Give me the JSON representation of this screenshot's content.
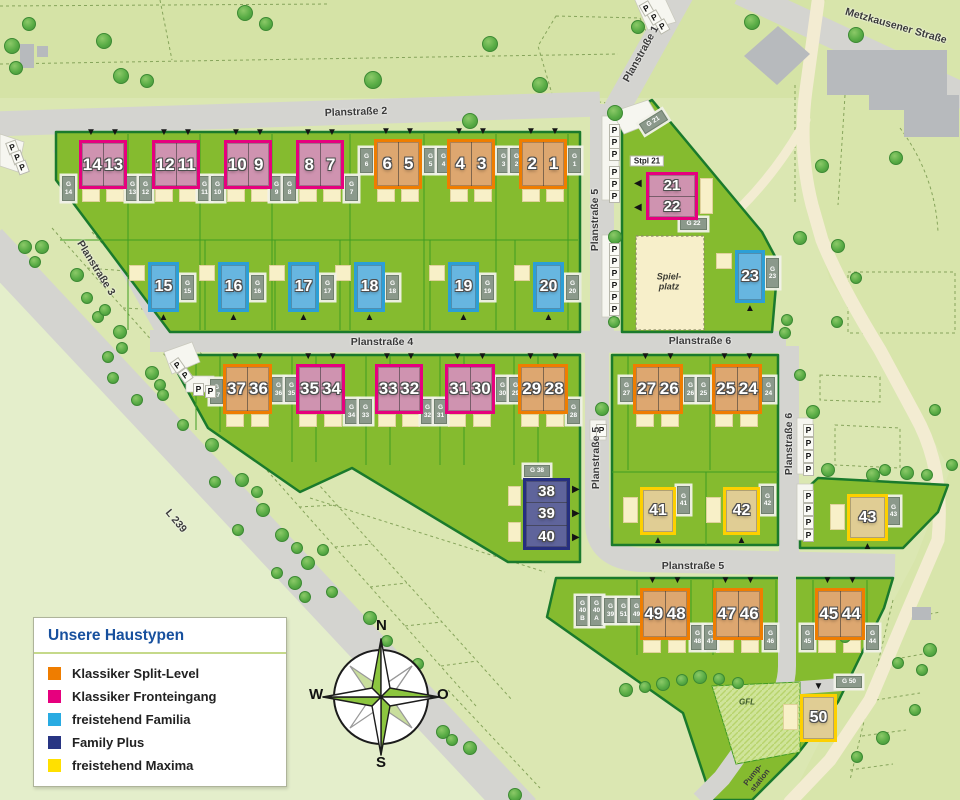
{
  "colors": {
    "split": "#ef7d00",
    "split_fill": "#dda770",
    "front": "#e6007e",
    "front_fill": "#cf93b0",
    "familia": "#2c9fd6",
    "familia_fill": "#67b6e0",
    "plus": "#262f7f",
    "plus_fill": "#5f649b",
    "maxima": "#fdd000",
    "maxima_fill": "#e0cd94",
    "legend_split": "#ef7d00",
    "legend_front": "#e6007e",
    "legend_familia": "#29abe2",
    "legend_plus": "#283583",
    "legend_maxima": "#ffe000",
    "dev_green": "#85bb2f",
    "road_gray": "#d4d4d0"
  },
  "legend": {
    "title": "Unsere Haustypen",
    "items": [
      {
        "key": "legend_split",
        "label": "Klassiker Split-Level"
      },
      {
        "key": "legend_front",
        "label": "Klassiker Fronteingang"
      },
      {
        "key": "legend_familia",
        "label": "freistehend Familia"
      },
      {
        "key": "legend_plus",
        "label": "Family Plus"
      },
      {
        "key": "legend_maxima",
        "label": "freistehend Maxima"
      }
    ]
  },
  "compass": {
    "north": "N",
    "east": "O",
    "south": "S",
    "west": "W"
  },
  "street_labels": [
    {
      "text": "Planstraße 2",
      "x": 356,
      "y": 112,
      "rot": -2
    },
    {
      "text": "Planstraße 1",
      "x": 641,
      "y": 54,
      "rot": -61
    },
    {
      "text": "Planstraße 3",
      "x": 96,
      "y": 268,
      "rot": 58
    },
    {
      "text": "Planstraße 4",
      "x": 382,
      "y": 342,
      "rot": 0
    },
    {
      "text": "Planstraße 5",
      "x": 595,
      "y": 220,
      "rot": -90
    },
    {
      "text": "Planstraße 5",
      "x": 596,
      "y": 458,
      "rot": -90
    },
    {
      "text": "Planstraße 5",
      "x": 693,
      "y": 566,
      "rot": 0
    },
    {
      "text": "Planstraße 6",
      "x": 700,
      "y": 341,
      "rot": 0
    },
    {
      "text": "Planstraße 6",
      "x": 789,
      "y": 444,
      "rot": -90
    },
    {
      "text": "Metzkausener Straße",
      "x": 896,
      "y": 26,
      "rot": 16
    },
    {
      "text": "L 239",
      "x": 176,
      "y": 521,
      "rot": 50
    }
  ],
  "area_labels": [
    {
      "text": "Stpl 21",
      "x": 647,
      "y": 161,
      "cls": "box",
      "rot": 0
    },
    {
      "text": "Spiel-\nplatz",
      "x": 669,
      "y": 282,
      "cls": "spiel",
      "rot": 0
    },
    {
      "text": "GFL",
      "x": 747,
      "y": 702,
      "cls": "small-italic",
      "rot": 0
    },
    {
      "text": "Pump-\nstation",
      "x": 757,
      "y": 778,
      "cls": "small",
      "rot": -52
    }
  ],
  "houses": [
    {
      "units": [
        "14",
        "13"
      ],
      "type": "front",
      "x": 79,
      "y": 140,
      "w": 48,
      "h": 49,
      "dir": "h",
      "arrow": "top"
    },
    {
      "units": [
        "12",
        "11"
      ],
      "type": "front",
      "x": 152,
      "y": 140,
      "w": 48,
      "h": 49,
      "dir": "h",
      "arrow": "top"
    },
    {
      "units": [
        "10",
        "9"
      ],
      "type": "front",
      "x": 224,
      "y": 140,
      "w": 48,
      "h": 49,
      "dir": "h",
      "arrow": "top"
    },
    {
      "units": [
        "8",
        "7"
      ],
      "type": "front",
      "x": 296,
      "y": 140,
      "w": 48,
      "h": 49,
      "dir": "h",
      "arrow": "top"
    },
    {
      "units": [
        "6",
        "5"
      ],
      "type": "split",
      "x": 374,
      "y": 139,
      "w": 48,
      "h": 50,
      "dir": "h",
      "arrow": "top"
    },
    {
      "units": [
        "4",
        "3"
      ],
      "type": "split",
      "x": 447,
      "y": 139,
      "w": 48,
      "h": 50,
      "dir": "h",
      "arrow": "top"
    },
    {
      "units": [
        "2",
        "1"
      ],
      "type": "split",
      "x": 519,
      "y": 139,
      "w": 48,
      "h": 50,
      "dir": "h",
      "arrow": "top"
    },
    {
      "units": [
        "15"
      ],
      "type": "familia",
      "x": 148,
      "y": 262,
      "w": 31,
      "h": 50,
      "dir": "h",
      "arrow": "bottom"
    },
    {
      "units": [
        "16"
      ],
      "type": "familia",
      "x": 218,
      "y": 262,
      "w": 31,
      "h": 50,
      "dir": "h",
      "arrow": "bottom"
    },
    {
      "units": [
        "17"
      ],
      "type": "familia",
      "x": 288,
      "y": 262,
      "w": 31,
      "h": 50,
      "dir": "h",
      "arrow": "bottom"
    },
    {
      "units": [
        "18"
      ],
      "type": "familia",
      "x": 354,
      "y": 262,
      "w": 31,
      "h": 50,
      "dir": "h",
      "arrow": "bottom"
    },
    {
      "units": [
        "19"
      ],
      "type": "familia",
      "x": 448,
      "y": 262,
      "w": 31,
      "h": 50,
      "dir": "h",
      "arrow": "bottom"
    },
    {
      "units": [
        "20"
      ],
      "type": "familia",
      "x": 533,
      "y": 262,
      "w": 31,
      "h": 50,
      "dir": "h",
      "arrow": "bottom"
    },
    {
      "units": [
        "21",
        "22"
      ],
      "type": "front",
      "x": 646,
      "y": 172,
      "w": 52,
      "h": 48,
      "dir": "v",
      "arrow": "left"
    },
    {
      "units": [
        "23"
      ],
      "type": "familia",
      "x": 735,
      "y": 250,
      "w": 30,
      "h": 53,
      "dir": "h",
      "arrow": "bottom"
    },
    {
      "units": [
        "37",
        "36"
      ],
      "type": "split",
      "x": 223,
      "y": 364,
      "w": 49,
      "h": 50,
      "dir": "h",
      "arrow": "top"
    },
    {
      "units": [
        "35",
        "34"
      ],
      "type": "front",
      "x": 296,
      "y": 364,
      "w": 49,
      "h": 50,
      "dir": "h",
      "arrow": "top"
    },
    {
      "units": [
        "33",
        "32"
      ],
      "type": "front",
      "x": 375,
      "y": 364,
      "w": 48,
      "h": 50,
      "dir": "h",
      "arrow": "top"
    },
    {
      "units": [
        "31",
        "30"
      ],
      "type": "front",
      "x": 445,
      "y": 364,
      "w": 50,
      "h": 50,
      "dir": "h",
      "arrow": "top"
    },
    {
      "units": [
        "29",
        "28"
      ],
      "type": "split",
      "x": 518,
      "y": 364,
      "w": 50,
      "h": 50,
      "dir": "h",
      "arrow": "top"
    },
    {
      "units": [
        "27",
        "26"
      ],
      "type": "split",
      "x": 633,
      "y": 364,
      "w": 50,
      "h": 50,
      "dir": "h",
      "arrow": "top"
    },
    {
      "units": [
        "25",
        "24"
      ],
      "type": "split",
      "x": 712,
      "y": 364,
      "w": 50,
      "h": 50,
      "dir": "h",
      "arrow": "top"
    },
    {
      "units": [
        "38",
        "39",
        "40"
      ],
      "type": "plus",
      "x": 523,
      "y": 478,
      "w": 47,
      "h": 72,
      "dir": "v",
      "arrow": "right"
    },
    {
      "units": [
        "41"
      ],
      "type": "maxima",
      "x": 640,
      "y": 487,
      "w": 36,
      "h": 48,
      "dir": "h",
      "arrow": "bottom"
    },
    {
      "units": [
        "42"
      ],
      "type": "maxima",
      "x": 723,
      "y": 487,
      "w": 37,
      "h": 48,
      "dir": "h",
      "arrow": "bottom"
    },
    {
      "units": [
        "43"
      ],
      "type": "maxima",
      "x": 847,
      "y": 494,
      "w": 41,
      "h": 47,
      "dir": "h",
      "arrow": "bottom"
    },
    {
      "units": [
        "49",
        "48"
      ],
      "type": "split",
      "x": 640,
      "y": 588,
      "w": 50,
      "h": 52,
      "dir": "h",
      "arrow": "top"
    },
    {
      "units": [
        "47",
        "46"
      ],
      "type": "split",
      "x": 713,
      "y": 588,
      "w": 50,
      "h": 52,
      "dir": "h",
      "arrow": "top"
    },
    {
      "units": [
        "45",
        "44"
      ],
      "type": "split",
      "x": 815,
      "y": 588,
      "w": 50,
      "h": 52,
      "dir": "h",
      "arrow": "top"
    },
    {
      "units": [
        "50"
      ],
      "type": "maxima",
      "x": 800,
      "y": 694,
      "w": 37,
      "h": 48,
      "dir": "h",
      "arrow": "top"
    }
  ],
  "garages": [
    {
      "lines": [
        "G",
        "14"
      ],
      "x": 62,
      "y": 176
    },
    {
      "lines": [
        "G",
        "13"
      ],
      "x": 126,
      "y": 176
    },
    {
      "lines": [
        "G",
        "12"
      ],
      "x": 139,
      "y": 176
    },
    {
      "lines": [
        "G",
        "11"
      ],
      "x": 198,
      "y": 176
    },
    {
      "lines": [
        "G",
        "10"
      ],
      "x": 211,
      "y": 176
    },
    {
      "lines": [
        "G",
        "9"
      ],
      "x": 270,
      "y": 176
    },
    {
      "lines": [
        "G",
        "8"
      ],
      "x": 283,
      "y": 176
    },
    {
      "lines": [
        "G",
        "7"
      ],
      "x": 345,
      "y": 176
    },
    {
      "lines": [
        "G",
        "6"
      ],
      "x": 360,
      "y": 148
    },
    {
      "lines": [
        "G",
        "5"
      ],
      "x": 424,
      "y": 148
    },
    {
      "lines": [
        "G",
        "4"
      ],
      "x": 437,
      "y": 148
    },
    {
      "lines": [
        "G",
        "3"
      ],
      "x": 497,
      "y": 148
    },
    {
      "lines": [
        "G",
        "2"
      ],
      "x": 510,
      "y": 148
    },
    {
      "lines": [
        "G",
        "1"
      ],
      "x": 568,
      "y": 148
    },
    {
      "lines": [
        "G",
        "15"
      ],
      "x": 181,
      "y": 275
    },
    {
      "lines": [
        "G",
        "16"
      ],
      "x": 251,
      "y": 275
    },
    {
      "lines": [
        "G",
        "17"
      ],
      "x": 321,
      "y": 275
    },
    {
      "lines": [
        "G",
        "18"
      ],
      "x": 386,
      "y": 275
    },
    {
      "lines": [
        "G",
        "19"
      ],
      "x": 481,
      "y": 275
    },
    {
      "lines": [
        "G",
        "20"
      ],
      "x": 566,
      "y": 275
    },
    {
      "lines": [
        "G 21"
      ],
      "x": 640,
      "y": 116,
      "w": 27,
      "h": 12,
      "rot": -32
    },
    {
      "lines": [
        "G 22"
      ],
      "x": 680,
      "y": 218,
      "w": 27,
      "h": 12
    },
    {
      "lines": [
        "G",
        "23"
      ],
      "x": 766,
      "y": 258,
      "h": 30
    },
    {
      "lines": [
        "G",
        "37"
      ],
      "x": 210,
      "y": 379
    },
    {
      "lines": [
        "G",
        "36"
      ],
      "x": 272,
      "y": 377
    },
    {
      "lines": [
        "G",
        "35"
      ],
      "x": 285,
      "y": 377
    },
    {
      "lines": [
        "G",
        "34"
      ],
      "x": 345,
      "y": 399
    },
    {
      "lines": [
        "G",
        "33"
      ],
      "x": 359,
      "y": 399
    },
    {
      "lines": [
        "G",
        "32"
      ],
      "x": 421,
      "y": 399
    },
    {
      "lines": [
        "G",
        "31"
      ],
      "x": 434,
      "y": 399
    },
    {
      "lines": [
        "G",
        "30"
      ],
      "x": 496,
      "y": 377
    },
    {
      "lines": [
        "G",
        "29"
      ],
      "x": 509,
      "y": 377
    },
    {
      "lines": [
        "G",
        "28"
      ],
      "x": 567,
      "y": 399
    },
    {
      "lines": [
        "G",
        "27"
      ],
      "x": 620,
      "y": 377
    },
    {
      "lines": [
        "G",
        "26"
      ],
      "x": 684,
      "y": 377
    },
    {
      "lines": [
        "G",
        "25"
      ],
      "x": 697,
      "y": 377
    },
    {
      "lines": [
        "G",
        "24"
      ],
      "x": 762,
      "y": 377
    },
    {
      "lines": [
        "G 38"
      ],
      "x": 524,
      "y": 465,
      "w": 26,
      "h": 12
    },
    {
      "lines": [
        "G",
        "41"
      ],
      "x": 677,
      "y": 486,
      "h": 28
    },
    {
      "lines": [
        "G",
        "42"
      ],
      "x": 761,
      "y": 486,
      "h": 28
    },
    {
      "lines": [
        "G",
        "43"
      ],
      "x": 887,
      "y": 497,
      "h": 28
    },
    {
      "lines": [
        "G",
        "40",
        "B"
      ],
      "x": 576,
      "y": 596,
      "h": 30
    },
    {
      "lines": [
        "G",
        "40",
        "A"
      ],
      "x": 590,
      "y": 596,
      "h": 30
    },
    {
      "lines": [
        "G",
        "39"
      ],
      "x": 604,
      "y": 598
    },
    {
      "lines": [
        "G",
        "51"
      ],
      "x": 617,
      "y": 598
    },
    {
      "lines": [
        "G",
        "49"
      ],
      "x": 630,
      "y": 598
    },
    {
      "lines": [
        "G",
        "48"
      ],
      "x": 691,
      "y": 625
    },
    {
      "lines": [
        "G",
        "47"
      ],
      "x": 704,
      "y": 625
    },
    {
      "lines": [
        "G",
        "46"
      ],
      "x": 764,
      "y": 625
    },
    {
      "lines": [
        "G",
        "45"
      ],
      "x": 801,
      "y": 625
    },
    {
      "lines": [
        "G",
        "44"
      ],
      "x": 866,
      "y": 625
    },
    {
      "lines": [
        "G 50"
      ],
      "x": 836,
      "y": 676,
      "w": 26,
      "h": 12
    }
  ],
  "parking_letter": "P",
  "parking": [
    {
      "x": 7,
      "y": 141,
      "rot": -20
    },
    {
      "x": 12,
      "y": 151,
      "rot": -20
    },
    {
      "x": 17,
      "y": 161,
      "rot": -20
    },
    {
      "x": 641,
      "y": 2,
      "rot": -30
    },
    {
      "x": 649,
      "y": 11,
      "rot": -30
    },
    {
      "x": 657,
      "y": 20,
      "rot": -30
    },
    {
      "x": 609,
      "y": 124,
      "rot": 0
    },
    {
      "x": 609,
      "y": 136,
      "rot": 0
    },
    {
      "x": 609,
      "y": 148,
      "rot": 0
    },
    {
      "x": 609,
      "y": 166,
      "rot": 0
    },
    {
      "x": 609,
      "y": 178,
      "rot": 0
    },
    {
      "x": 609,
      "y": 190,
      "rot": 0
    },
    {
      "x": 609,
      "y": 243,
      "rot": 0
    },
    {
      "x": 609,
      "y": 255,
      "rot": 0
    },
    {
      "x": 609,
      "y": 267,
      "rot": 0
    },
    {
      "x": 609,
      "y": 279,
      "rot": 0
    },
    {
      "x": 609,
      "y": 291,
      "rot": 0
    },
    {
      "x": 609,
      "y": 303,
      "rot": 0
    },
    {
      "x": 172,
      "y": 359,
      "rot": -35
    },
    {
      "x": 180,
      "y": 369,
      "rot": -35
    },
    {
      "x": 193,
      "y": 383,
      "rot": 0
    },
    {
      "x": 205,
      "y": 385,
      "rot": 0
    },
    {
      "x": 596,
      "y": 424,
      "rot": 0
    },
    {
      "x": 803,
      "y": 424,
      "rot": 0
    },
    {
      "x": 803,
      "y": 437,
      "rot": 0
    },
    {
      "x": 803,
      "y": 450,
      "rot": 0
    },
    {
      "x": 803,
      "y": 463,
      "rot": 0
    },
    {
      "x": 803,
      "y": 490,
      "rot": 0
    },
    {
      "x": 803,
      "y": 503,
      "rot": 0
    },
    {
      "x": 803,
      "y": 516,
      "rot": 0
    },
    {
      "x": 803,
      "y": 529,
      "rot": 0
    }
  ],
  "trees": [
    [
      12,
      46,
      8
    ],
    [
      29,
      24,
      7
    ],
    [
      16,
      68,
      7
    ],
    [
      104,
      41,
      8
    ],
    [
      121,
      76,
      8
    ],
    [
      147,
      81,
      7
    ],
    [
      245,
      13,
      8
    ],
    [
      266,
      24,
      7
    ],
    [
      373,
      80,
      9
    ],
    [
      470,
      121,
      8
    ],
    [
      490,
      44,
      8
    ],
    [
      540,
      85,
      8
    ],
    [
      638,
      27,
      7
    ],
    [
      752,
      22,
      8
    ],
    [
      856,
      35,
      8
    ],
    [
      822,
      166,
      7
    ],
    [
      896,
      158,
      7
    ],
    [
      615,
      113,
      8
    ],
    [
      615,
      237,
      7
    ],
    [
      614,
      322,
      6
    ],
    [
      800,
      238,
      7
    ],
    [
      838,
      246,
      7
    ],
    [
      856,
      278,
      6
    ],
    [
      787,
      320,
      6
    ],
    [
      837,
      322,
      6
    ],
    [
      785,
      333,
      6
    ],
    [
      602,
      409,
      7
    ],
    [
      25,
      247,
      7
    ],
    [
      42,
      247,
      7
    ],
    [
      35,
      262,
      6
    ],
    [
      77,
      275,
      7
    ],
    [
      87,
      298,
      6
    ],
    [
      98,
      317,
      6
    ],
    [
      105,
      310,
      6
    ],
    [
      120,
      332,
      7
    ],
    [
      122,
      348,
      6
    ],
    [
      108,
      357,
      6
    ],
    [
      113,
      378,
      6
    ],
    [
      152,
      373,
      7
    ],
    [
      160,
      385,
      6
    ],
    [
      163,
      395,
      6
    ],
    [
      137,
      400,
      6
    ],
    [
      183,
      425,
      6
    ],
    [
      212,
      445,
      7
    ],
    [
      215,
      482,
      6
    ],
    [
      242,
      480,
      7
    ],
    [
      257,
      492,
      6
    ],
    [
      263,
      510,
      7
    ],
    [
      238,
      530,
      6
    ],
    [
      282,
      535,
      7
    ],
    [
      297,
      548,
      6
    ],
    [
      308,
      563,
      7
    ],
    [
      323,
      550,
      6
    ],
    [
      277,
      573,
      6
    ],
    [
      295,
      583,
      7
    ],
    [
      305,
      597,
      6
    ],
    [
      332,
      592,
      6
    ],
    [
      370,
      618,
      7
    ],
    [
      387,
      641,
      6
    ],
    [
      418,
      664,
      6
    ],
    [
      443,
      732,
      7
    ],
    [
      452,
      740,
      6
    ],
    [
      470,
      748,
      7
    ],
    [
      515,
      795,
      7
    ],
    [
      813,
      412,
      7
    ],
    [
      828,
      470,
      7
    ],
    [
      873,
      475,
      7
    ],
    [
      885,
      470,
      6
    ],
    [
      907,
      473,
      7
    ],
    [
      927,
      475,
      6
    ],
    [
      935,
      410,
      6
    ],
    [
      952,
      465,
      6
    ],
    [
      800,
      375,
      6
    ],
    [
      930,
      650,
      7
    ],
    [
      922,
      670,
      6
    ],
    [
      898,
      663,
      6
    ],
    [
      915,
      710,
      6
    ],
    [
      883,
      738,
      7
    ],
    [
      857,
      757,
      6
    ],
    [
      845,
      637,
      6
    ],
    [
      626,
      690,
      7
    ],
    [
      645,
      687,
      6
    ],
    [
      663,
      684,
      7
    ],
    [
      682,
      680,
      6
    ],
    [
      700,
      677,
      7
    ],
    [
      719,
      679,
      6
    ],
    [
      738,
      683,
      6
    ]
  ]
}
